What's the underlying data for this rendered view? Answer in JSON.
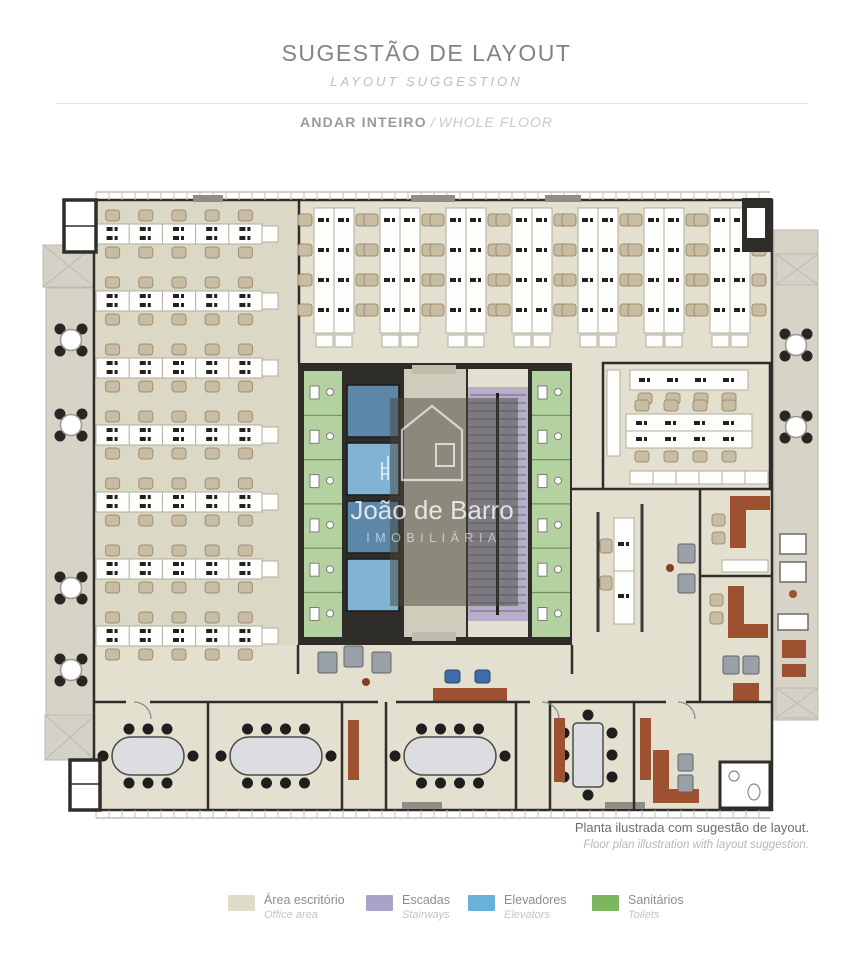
{
  "header": {
    "title": "SUGESTÃO DE LAYOUT",
    "subtitle": "LAYOUT SUGGESTION",
    "section_title": "ANDAR INTEIRO",
    "section_separator": " / ",
    "section_subtitle": "WHOLE FLOOR"
  },
  "watermark": {
    "name": "João de Barro",
    "tagline": "IMOBILIÁRIA"
  },
  "caption": {
    "pt": "Planta ilustrada com sugestão de layout.",
    "en": "Floor plan illustration with layout suggestion."
  },
  "legend": {
    "items": [
      {
        "id": "office",
        "label_pt": "Área escritório",
        "label_en": "Office area",
        "color": "#deddc9"
      },
      {
        "id": "stairs",
        "label_pt": "Escadas",
        "label_en": "Stairways",
        "color": "#a7a3c9"
      },
      {
        "id": "elevators",
        "label_pt": "Elevadores",
        "label_en": "Elevators",
        "color": "#68b2da"
      },
      {
        "id": "toilets",
        "label_pt": "Sanitários",
        "label_en": "Toilets",
        "color": "#7cb65e"
      }
    ]
  },
  "floor_plan": {
    "colors": {
      "wall": "#2e2d29",
      "floor": "#e4e0cf",
      "floor_left": "#dcd8c6",
      "balcony": "#d7d4c7",
      "pad": "#d4d2c7",
      "pad_line": "#bcbab0",
      "corridor": "#d0ccbc",
      "toilets": "#b4d2a0",
      "toilet_line": "#6f8f5c",
      "elevator_dark": "#5d87a8",
      "elevator_light": "#80b3d4",
      "stairs": "#b4aec8",
      "stairs_line": "#6b6580",
      "desk": "#fdfdfb",
      "desk_line": "#b0ada1",
      "glyph": "#22211f",
      "chair_tan": "#c8bca3",
      "chair_tan_line": "#9d8f71",
      "chair_black": "#1e1e1e",
      "table_top": "#dcdde1",
      "wood": "#9d5130",
      "chair_gray": "#9aa0a7",
      "chair_blue": "#3d6ea9",
      "white": "#ffffff",
      "sill": "#8f8d85",
      "hatch": "#c2bfb2",
      "overlay": "rgba(72,70,60,0.5)",
      "wm_line": "rgba(255,255,255,0.65)",
      "wm_text": "rgba(255,255,255,0.78)",
      "wm_text2": "rgba(255,255,255,0.55)"
    },
    "left_benches": {
      "x": 66,
      "width": 166,
      "seats": 5,
      "rows_y": [
        62,
        129,
        196,
        263,
        330,
        397,
        464
      ]
    },
    "top_benches": {
      "y": 46,
      "height": 125,
      "seat_rows": 4,
      "width": 40,
      "cols_x": [
        284,
        350,
        416,
        482,
        548,
        614,
        680
      ]
    },
    "elevator_cars_y": [
      223,
      281,
      339,
      397
    ],
    "balcony_left_tables_y": [
      178,
      263,
      426,
      508
    ],
    "balcony_right_tables_y": [
      183,
      265
    ],
    "meeting_rooms": [
      {
        "type": "oval",
        "cx": 118,
        "cy": 594,
        "rx": 36,
        "ry": 19,
        "top": 3,
        "bottom": 3
      },
      {
        "type": "oval",
        "cx": 246,
        "cy": 594,
        "rx": 46,
        "ry": 19,
        "top": 4,
        "bottom": 4
      },
      {
        "type": "oval",
        "cx": 420,
        "cy": 594,
        "rx": 46,
        "ry": 19,
        "top": 4,
        "bottom": 4
      },
      {
        "type": "rect_v",
        "cx": 558,
        "cy": 593,
        "w": 30,
        "h": 64,
        "left": 3,
        "right": 3
      }
    ]
  }
}
